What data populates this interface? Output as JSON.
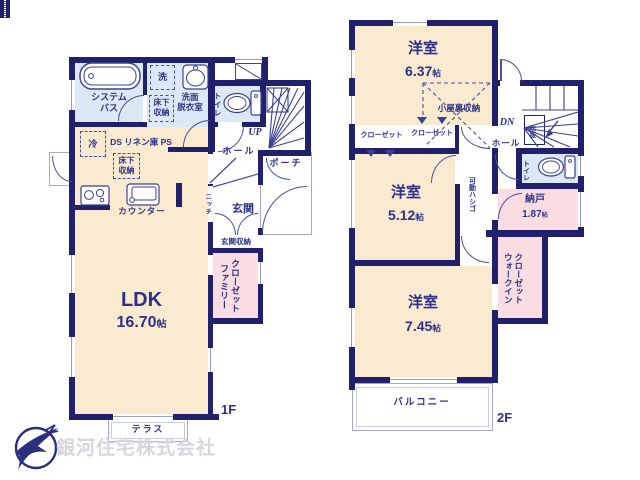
{
  "unit": "帖",
  "company": "銀河住宅株式会社",
  "floor1": {
    "floor": "1F",
    "ldk": "LDK",
    "ldk_area": "16.70",
    "bath": "システム\nバス",
    "washroom": "洗面\n脱衣室",
    "washer": "洗",
    "underfloor1": "床下\n収納",
    "underfloor2": "床下\n収納",
    "fridge": "冷",
    "ducts": "DS リネン庫 PS",
    "counter": "カウンター",
    "toilet": "トイレ",
    "up": "UP",
    "hall": "ホール",
    "porch": "ポーチ",
    "genkan": "玄関",
    "niche": "ニッチ",
    "shoe": "玄関収納",
    "family": "ファミリー\nクローゼット",
    "terrace": "テラス"
  },
  "floor2": {
    "floor": "2F",
    "room1": "洋室",
    "room1_area": "6.37",
    "attic": "小屋裏収納",
    "closet1": "クローゼット",
    "closet2": "クローゼット",
    "room2": "洋室",
    "room2_area": "5.12",
    "ladder": "可動ハシゴ",
    "dn": "DN",
    "hall": "ホール",
    "void": "吹抜",
    "toilet": "トイレ",
    "nando": "納戸",
    "nando_area": "1.87",
    "wic": "ウォークイン\nクローゼット",
    "room3": "洋室",
    "room3_area": "7.45",
    "balcony": "バルコニー"
  },
  "colors": {
    "wall": "#20206d",
    "room": "#f9ead0",
    "closet": "#fadde2",
    "wet": "#dce8f5",
    "line": "#4a4f9e",
    "text": "#2d3187"
  }
}
